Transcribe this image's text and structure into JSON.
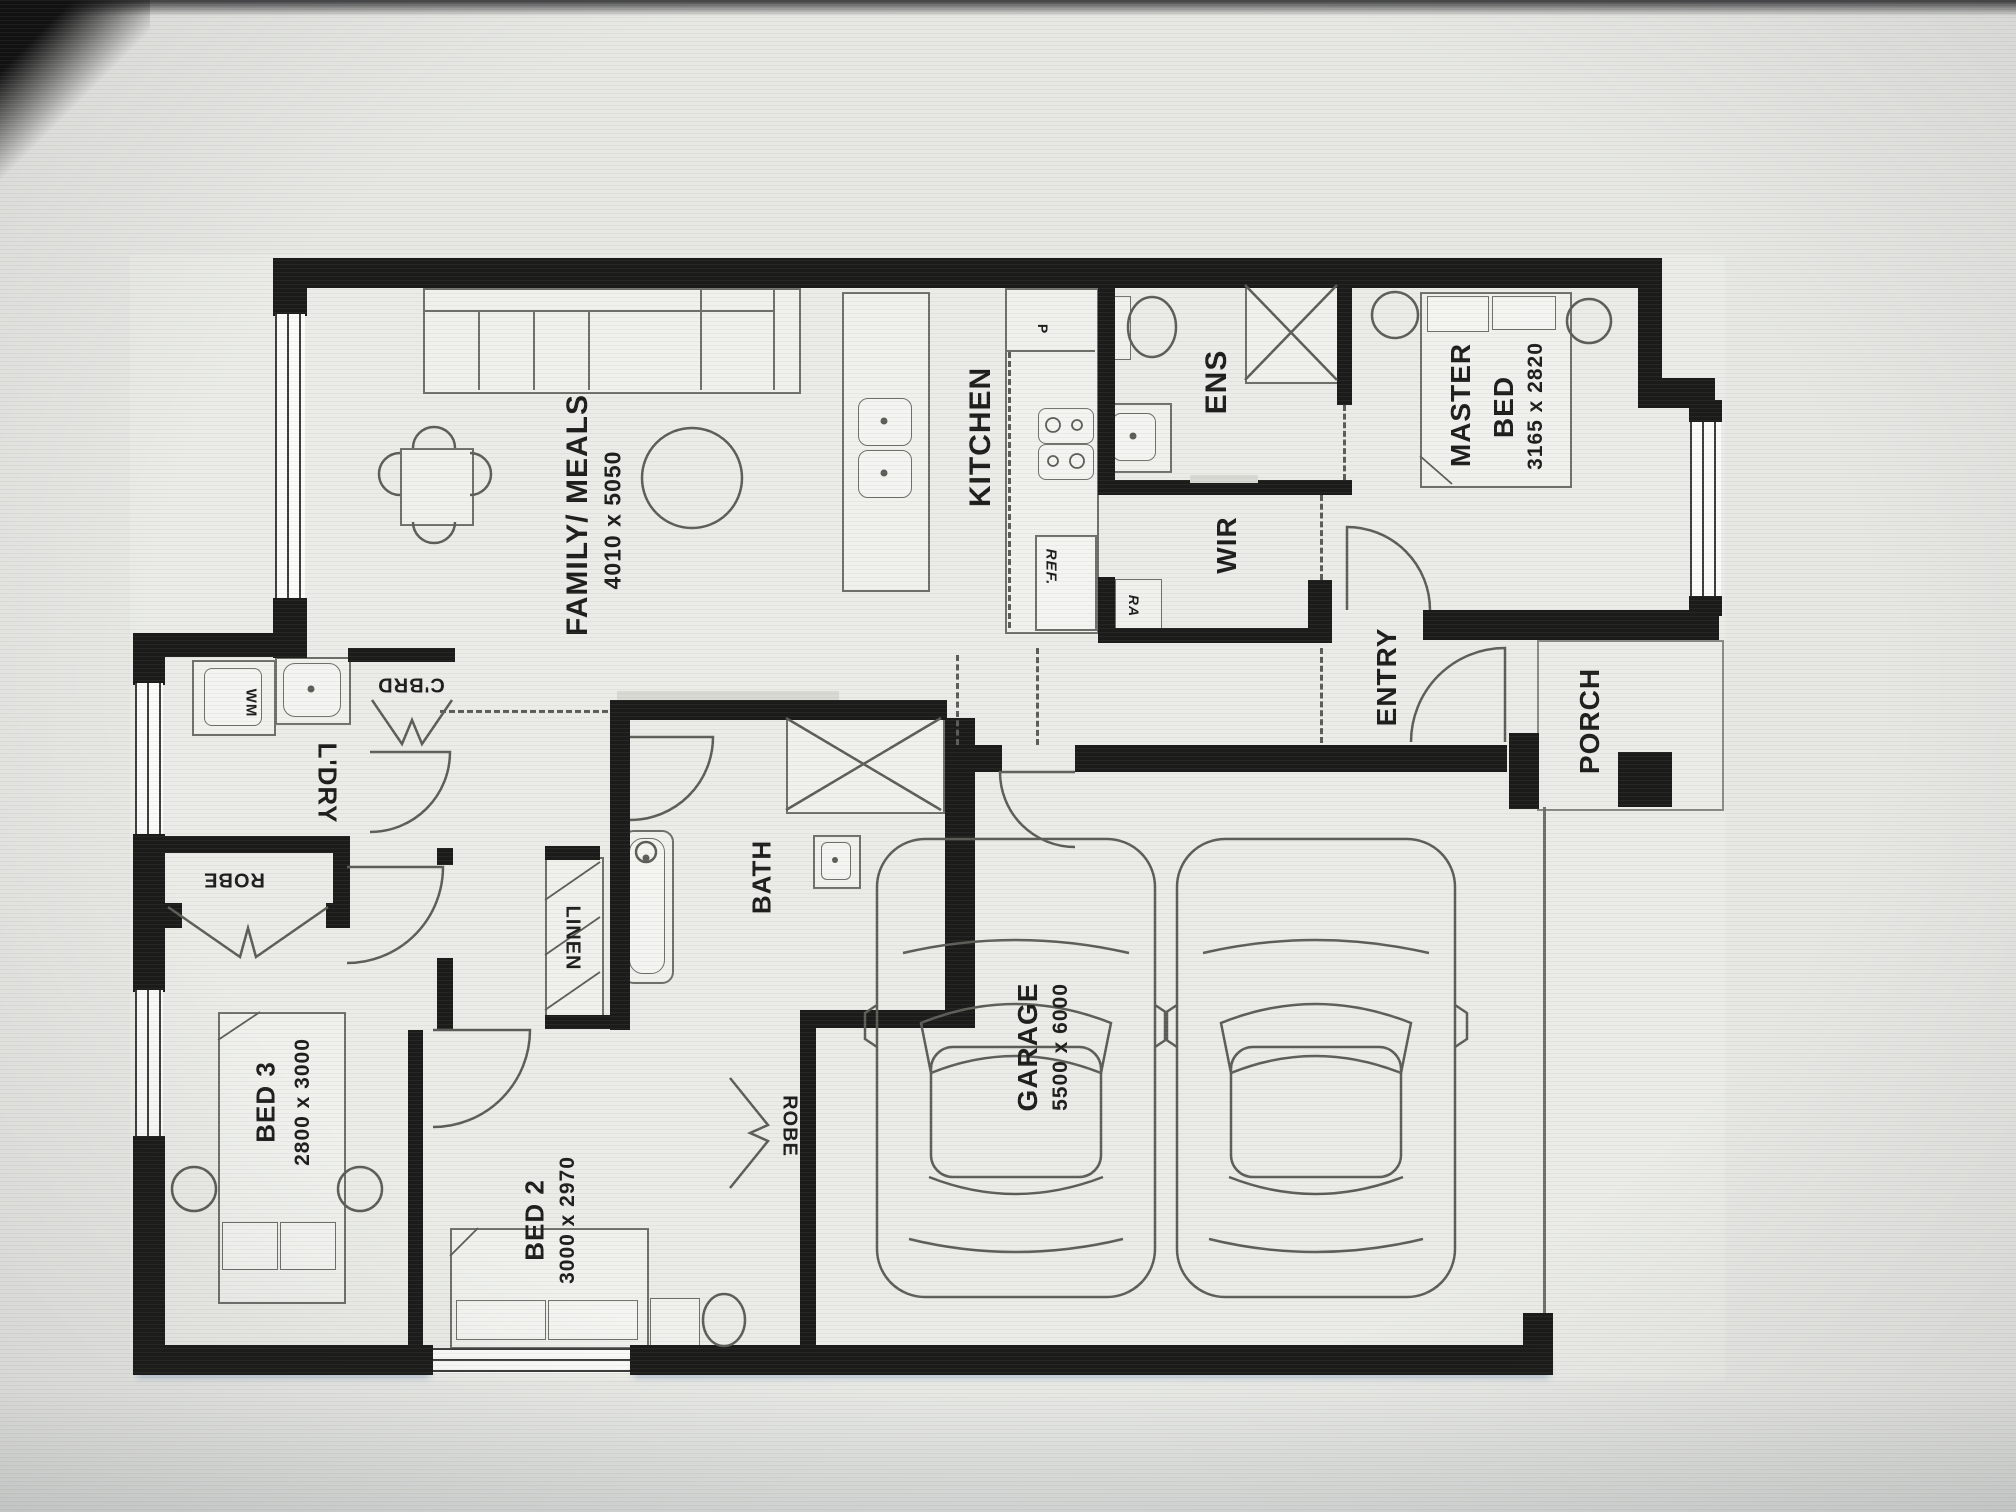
{
  "meta": {
    "type": "floor-plan-photo",
    "orientation": "plan rotated 90deg counter-clockwise in photo",
    "wall_color": "#1b1b19",
    "paper_color": "#ebece7"
  },
  "labels": {
    "family": {
      "name": "FAMILY/ MEALS",
      "dims": "4010 x 5050"
    },
    "kitchen": {
      "name": "KITCHEN"
    },
    "pantry": {
      "name": "P"
    },
    "fridge": {
      "name": "REF."
    },
    "return_air": {
      "name": "RA"
    },
    "ens": {
      "name": "ENS"
    },
    "wir": {
      "name": "WIR"
    },
    "master": {
      "line1": "MASTER",
      "line2": "BED",
      "dims": "3165 x 2820"
    },
    "entry": {
      "name": "ENTRY"
    },
    "porch": {
      "name": "PORCH"
    },
    "garage": {
      "name": "GARAGE",
      "dims": "5500 x 6000"
    },
    "laundry": {
      "name": "L'DRY"
    },
    "wm": {
      "name": "WM"
    },
    "cupboard": {
      "name": "C'BRD"
    },
    "robe_bed3": {
      "name": "ROBE"
    },
    "robe_bed2": {
      "name": "ROBE"
    },
    "linen": {
      "name": "LINEN"
    },
    "bath": {
      "name": "BATH"
    },
    "bed3": {
      "name": "BED 3",
      "dims": "2800 x 3000"
    },
    "bed2": {
      "name": "BED 2",
      "dims": "3000 x 2970"
    }
  }
}
